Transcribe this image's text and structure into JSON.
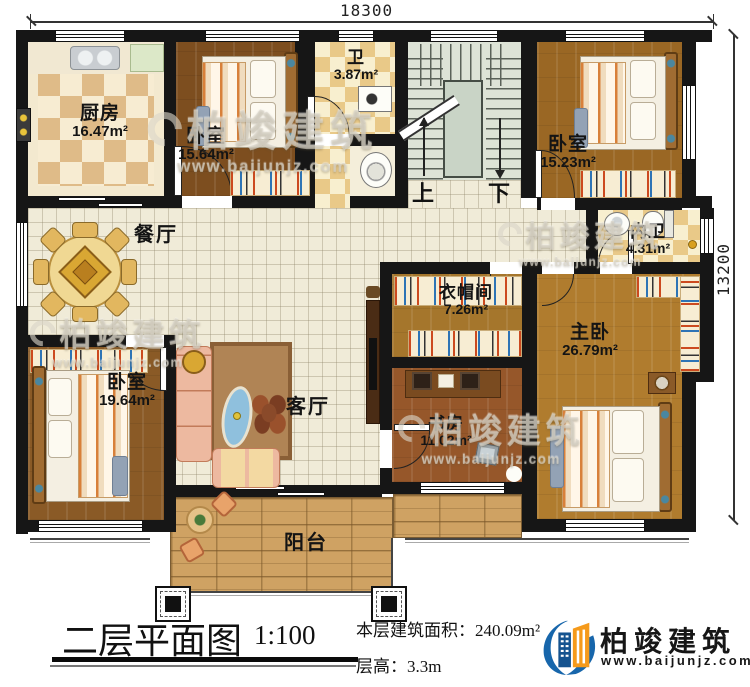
{
  "dimensions": {
    "top": "18300",
    "right": "13200"
  },
  "rooms": [
    {
      "name": "厨房",
      "area": "16.47m²"
    },
    {
      "name": "卧室",
      "area": "15.64m²"
    },
    {
      "name": "卫",
      "area": "3.87m²"
    },
    {
      "name": "卧室",
      "area": "15.23m²"
    },
    {
      "name": "内卫",
      "area": "4.31m²"
    },
    {
      "name": "餐厅",
      "area": ""
    },
    {
      "name": "衣帽间",
      "area": "7.26m²"
    },
    {
      "name": "主卧",
      "area": "26.79m²"
    },
    {
      "name": "卧室",
      "area": "19.64m²"
    },
    {
      "name": "客厅",
      "area": ""
    },
    {
      "name": "书房",
      "area": "11.02m²"
    },
    {
      "name": "阳台",
      "area": ""
    }
  ],
  "stairs": {
    "up": "上",
    "down": "下"
  },
  "footer": {
    "title": "二层平面图",
    "scale": "1:100",
    "area_text": "本层建筑面积：240.09m²",
    "height_text": "层高：3.3m"
  },
  "brand": {
    "name": "柏竣建筑",
    "site": "www.baijunjz.com"
  },
  "watermark": {
    "text": "柏竣建筑",
    "site": "www.baijunjz.com"
  },
  "colors": {
    "wall": "#161616",
    "brand_blue": "#1766ab",
    "brand_orange": "#f59a1b"
  }
}
